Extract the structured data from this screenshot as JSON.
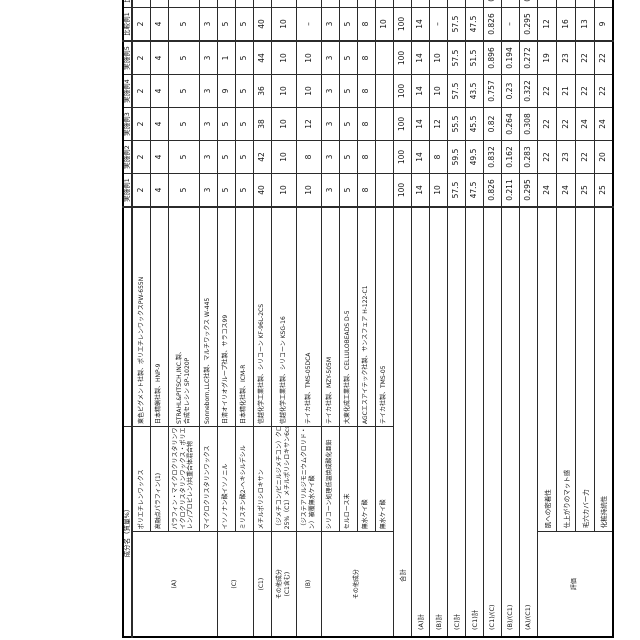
{
  "table": {
    "name_header": "成分名（質量%）",
    "columns": [
      "実施例1",
      "実施例2",
      "実施例3",
      "実施例4",
      "実施例5",
      "比較例1",
      "比較例2"
    ],
    "rows": [
      {
        "group": {
          "label": [
            "(A)"
          ],
          "span": 4
        },
        "name": [
          "ポリエチレンワックス"
        ],
        "supplier": [
          "東色ピグメント社製、ポリエチレンワックスPW-655N"
        ],
        "values": [
          2,
          2,
          2,
          2,
          2,
          2,
          2
        ]
      },
      {
        "name": [
          "高融点パラフィン(1)"
        ],
        "supplier": [
          "日本精蝋社製、HNP-9"
        ],
        "values": [
          4,
          4,
          4,
          4,
          4,
          4,
          4
        ]
      },
      {
        "name": [
          "パラフィン・マイクロクリスタリンワックス・水添マ",
          "イクロクリスタリンワックス・ポリエチレン・(エチ",
          "レン/プロピレン)共重合体混合物"
        ],
        "supplier": [
          "STRAHL&PITSCH,INC.製、",
          "合成セレシン SP-1020P"
        ],
        "values": [
          5,
          5,
          5,
          5,
          5,
          5,
          5
        ]
      },
      {
        "name": [
          "マイクロクリスタリンワックス"
        ],
        "supplier": [
          "Sonneborn,LLC社製、マルチワックス W-445"
        ],
        "values": [
          3,
          3,
          3,
          3,
          3,
          3,
          3
        ]
      },
      {
        "group": {
          "label": [
            "(C)"
          ],
          "span": 2
        },
        "name": [
          "イソノナン酸イソノニル"
        ],
        "supplier": [
          "日清オイリオグループ社製、サラコス99"
        ],
        "values": [
          5,
          5,
          5,
          9,
          1,
          5,
          21.5
        ]
      },
      {
        "name": [
          "ミリスチン酸2-ヘキシルデシル"
        ],
        "supplier": [
          "日本精化社製、ICM-R"
        ],
        "values": [
          5,
          5,
          5,
          5,
          5,
          5,
          21.5
        ]
      },
      {
        "group": {
          "label": [
            "(C1)"
          ],
          "span": 1
        },
        "name": [
          "メチルポリシロキサン"
        ],
        "supplier": [
          "信越化学工業社製、シリコーン KF-96L-2CS"
        ],
        "values": [
          40,
          42,
          38,
          36,
          44,
          40,
          7
        ]
      },
      {
        "group": {
          "label": [
            "その他成分",
            "(C1含む)"
          ],
          "span": 1
        },
        "name": [
          "（ジメチコン/ビニルジメチコン）クロスポリマー",
          "25%（C1）メチルポリシロキサン6cs混液"
        ],
        "supplier": [
          "信越化学工業社製、シリコーン KSG-16"
        ],
        "values": [
          10,
          10,
          10,
          10,
          10,
          10,
          10
        ]
      },
      {
        "group": {
          "label": [
            "(B)"
          ],
          "span": 1
        },
        "name": [
          "（ジステアリルジモニウムクロリド・アモジメチコ",
          "ン）被覆無水ケイ酸"
        ],
        "supplier": [
          "テイカ社製、TMS-05DCA"
        ],
        "values": [
          10,
          8,
          12,
          10,
          10,
          "–",
          10
        ]
      },
      {
        "group": {
          "label": [
            "その他成分"
          ],
          "span": 4
        },
        "name": [
          "シリコーン処理低温焼成酸化亜鉛"
        ],
        "supplier": [
          "テイカ社製、MZY-505M"
        ],
        "values": [
          3,
          3,
          3,
          3,
          3,
          3,
          3
        ]
      },
      {
        "name": [
          "セルロース末"
        ],
        "supplier": [
          "大東化成工業社製、CELLULOBEADS D-5"
        ],
        "values": [
          5,
          5,
          5,
          5,
          5,
          5,
          5
        ]
      },
      {
        "name": [
          "無水ケイ酸"
        ],
        "supplier": [
          "AGCエスアイテック社製、サンスフェア H-122-C1"
        ],
        "values": [
          8,
          8,
          8,
          8,
          8,
          8,
          8
        ]
      },
      {
        "name": [
          "無水ケイ酸"
        ],
        "supplier": [
          "テイカ社製、TMS-05"
        ],
        "values": [
          "",
          "",
          "",
          "",
          "",
          10,
          ""
        ]
      }
    ],
    "total_row": {
      "label": "合計",
      "values": [
        100,
        100,
        100,
        100,
        100,
        100,
        100
      ]
    },
    "summary_rows": [
      {
        "label": "(A)計",
        "values": [
          14,
          14,
          14,
          14,
          14,
          14,
          14
        ]
      },
      {
        "label": "(B)計",
        "values": [
          10,
          8,
          12,
          10,
          10,
          "–",
          10
        ]
      },
      {
        "label": "(C)計",
        "values": [
          57.5,
          59.5,
          55.5,
          57.5,
          57.5,
          57.5,
          57.5
        ]
      },
      {
        "label": "(C1)計",
        "values": [
          47.5,
          49.5,
          45.5,
          43.5,
          51.5,
          47.5,
          14.5
        ]
      },
      {
        "label": "(C1)/(C)",
        "values": [
          0.826,
          0.832,
          0.82,
          0.757,
          0.896,
          0.826,
          0.252
        ]
      },
      {
        "label": "(B)/(C1)",
        "values": [
          0.211,
          0.162,
          0.264,
          0.23,
          0.194,
          "–",
          0.69
        ]
      },
      {
        "label": "(A)/(C1)",
        "values": [
          0.295,
          0.283,
          0.308,
          0.322,
          0.272,
          0.295,
          0.966
        ]
      }
    ],
    "eval_group_label": "評価",
    "eval_rows": [
      {
        "label": "肌への密着性",
        "values": [
          24,
          22,
          22,
          22,
          19,
          12,
          13
        ]
      },
      {
        "label": "仕上がりのマット感",
        "values": [
          24,
          23,
          22,
          21,
          23,
          16,
          14
        ]
      },
      {
        "label": "毛穴カバー力",
        "values": [
          25,
          22,
          24,
          22,
          22,
          13,
          13
        ]
      },
      {
        "label": "化粧持続性",
        "values": [
          25,
          20,
          24,
          22,
          22,
          9,
          11
        ]
      }
    ]
  }
}
